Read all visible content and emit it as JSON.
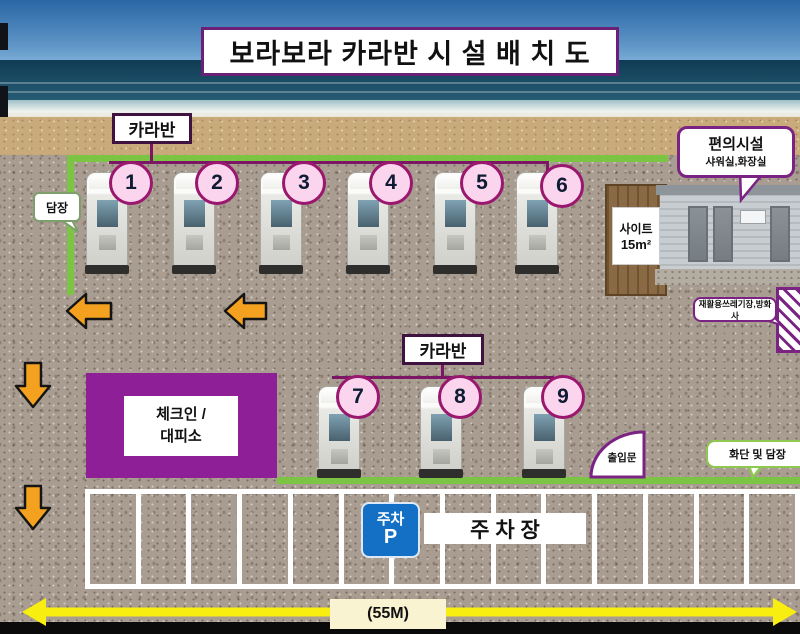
{
  "title": "보라보라 카라반 시 설 배 치 도",
  "caravan_section_row1": {
    "label": "카라반",
    "units": [
      "1",
      "2",
      "3",
      "4",
      "5",
      "6"
    ]
  },
  "caravan_section_row2": {
    "label": "카라반",
    "units": [
      "7",
      "8",
      "9"
    ]
  },
  "site_box": {
    "line1": "사이트",
    "line2": "15m²"
  },
  "bubbles": {
    "fence": "담장",
    "facilities_title": "편의시설",
    "facilities_sub": "샤워실,화장실",
    "recycle": "재활용쓰레기장,방화사",
    "flowerbed": "화단 및 담장"
  },
  "checkin": {
    "line1": "체크인 /",
    "line2": "대피소"
  },
  "entrance_label": "출입문",
  "parking": {
    "sign_top": "주차",
    "sign_letter": "P",
    "label": "주 차 장",
    "stall_count": 14
  },
  "measure": {
    "label": "(55M)"
  },
  "colors": {
    "fence_green": "#7cc544",
    "diagram_purple": "#7b2383",
    "connector_purple": "#7c1566",
    "checkin_purple": "#8e1f96",
    "badge_pink": "#fbd4ee",
    "badge_border": "#99176d",
    "arrow_orange": "#f3a11f",
    "measure_yellow": "#f8ee10",
    "parking_sign_blue": "#1470c4",
    "gravel": "#a99c90",
    "sand": "#c9ab7b"
  }
}
